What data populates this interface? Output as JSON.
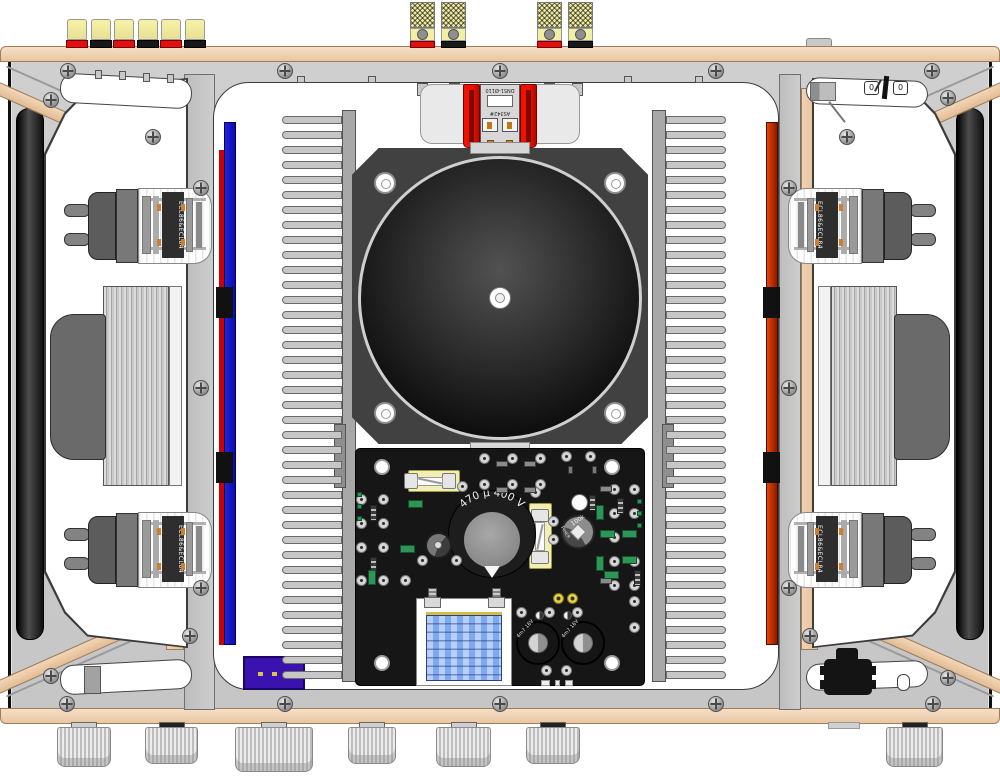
{
  "title": "Valve amplifier chassis — top view technical illustration",
  "labels": {
    "reservoir_capacitor": "470 µ 400 V",
    "electrolytic_capacitor": "4m7 16V",
    "trimmer_value": "100k",
    "trimmer_brand": "PIHER",
    "tube_type": "ECL86&ECL84",
    "mains_connector_line1": "DN51-Ø110",
    "mains_connector_line2": "AS342#",
    "power_switch_left": "0",
    "power_switch_right": "0"
  },
  "colors": {
    "wood": "#eccaa4",
    "top_plate": "#c9c9c9",
    "pcb_black": "#161616",
    "left_edge_strip_blue": "#1a1ad0",
    "right_edge_strip_orange": "#d04000",
    "transformer_bracket_red": "#ee1500",
    "connector_purple": "#3a12ad",
    "capacitor_blue": "#7da8f2",
    "terminal_yellow": "#f0eca0"
  }
}
